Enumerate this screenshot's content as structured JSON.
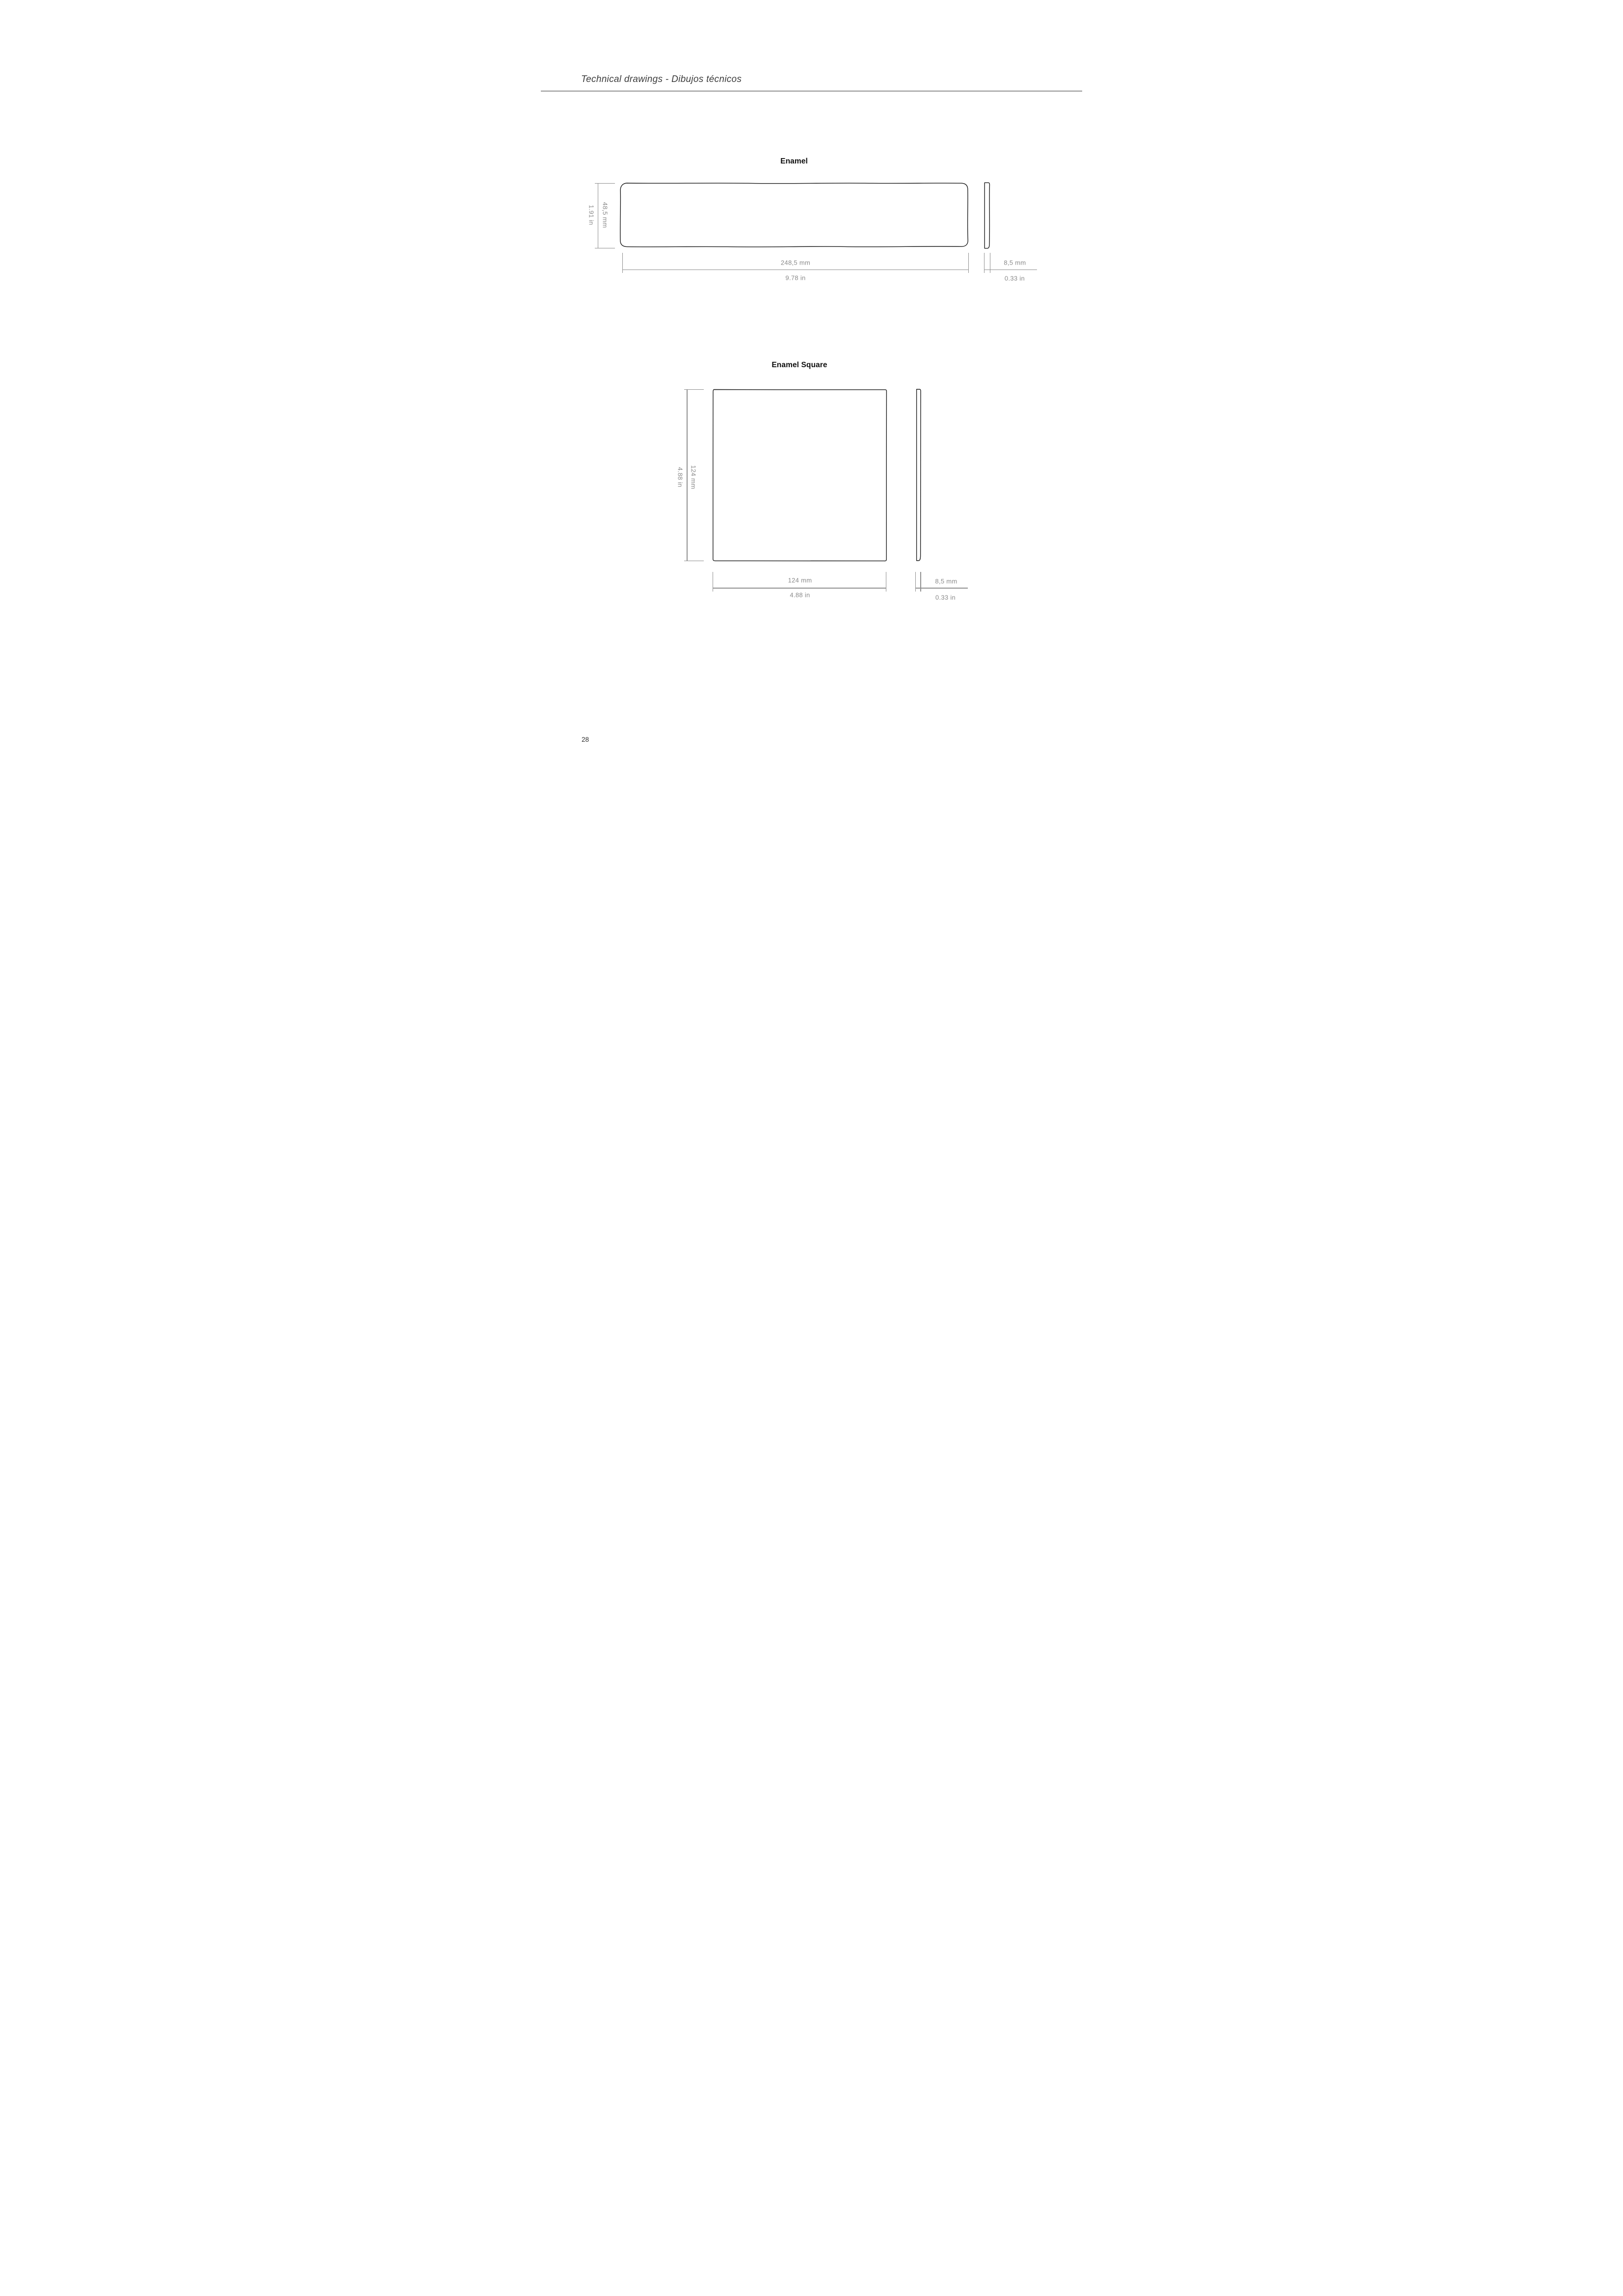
{
  "header": {
    "title": "Technical drawings - Dibujos técnicos"
  },
  "drawings": [
    {
      "name": "Enamel",
      "height_mm": "48,5 mm",
      "height_in": "1.91 in",
      "width_mm": "248,5 mm",
      "width_in": "9.78 in",
      "thickness_mm": "8,5 mm",
      "thickness_in": "0.33 in"
    },
    {
      "name": "Enamel Square",
      "height_mm": "124 mm",
      "height_in": "4.88 in",
      "width_mm": "124 mm",
      "width_in": "4.88 in",
      "thickness_mm": "8,5 mm",
      "thickness_in": "0.33 in"
    }
  ],
  "footer": {
    "page_number": "28"
  },
  "colors": {
    "dimension_line": "#909090",
    "dimension_text": "#8a8a8a",
    "drawing_outline": "#1c1c1c",
    "header_rule": "#2d2d2d",
    "title_text": "#101010"
  }
}
